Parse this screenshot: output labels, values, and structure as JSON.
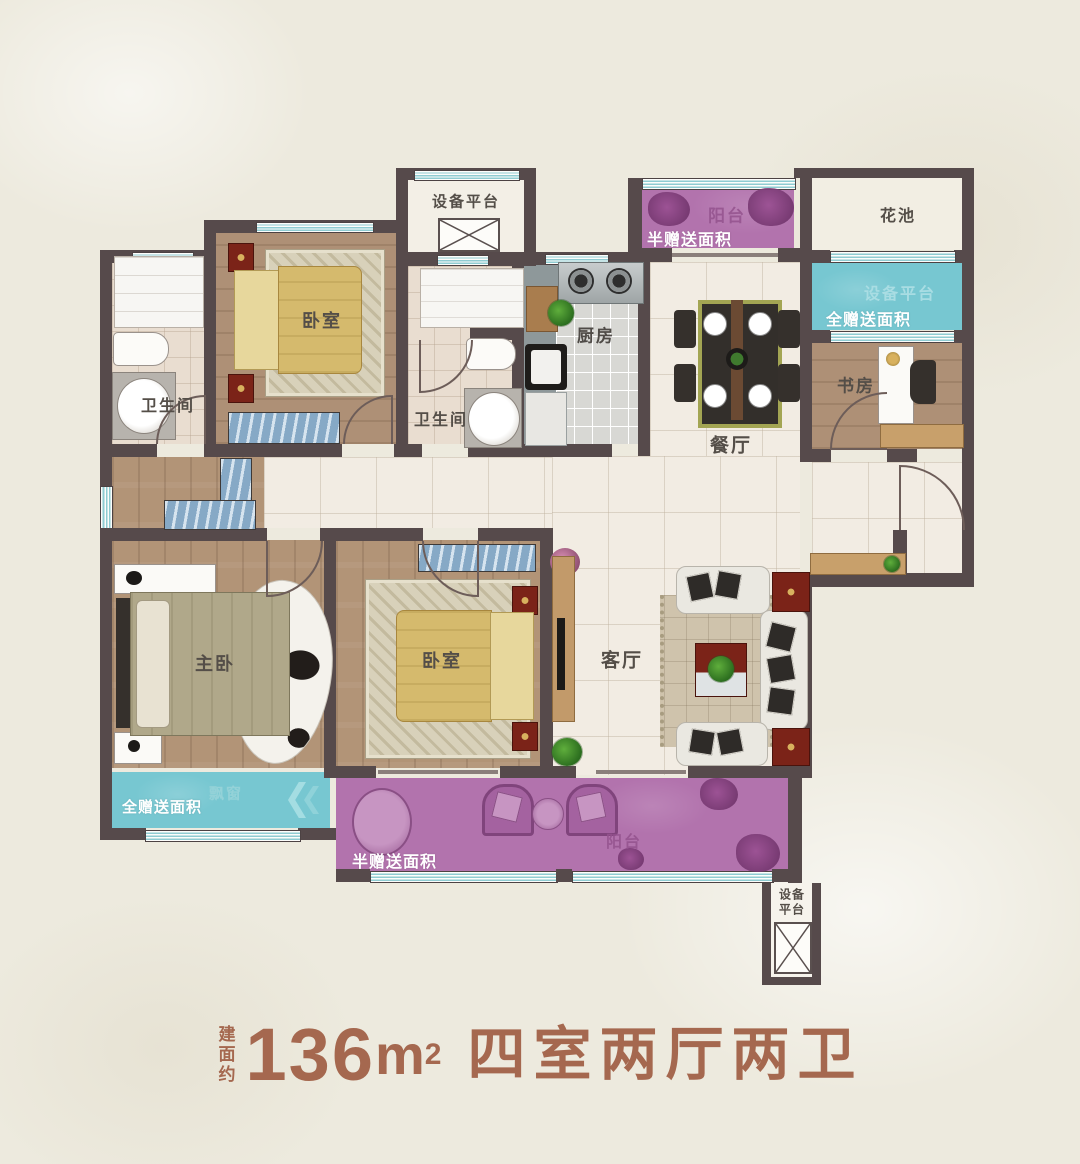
{
  "labels": {
    "equip_top": "设备平台",
    "balcony_top": "阳台",
    "flower_bed": "花池",
    "equip_right": "设备平台",
    "study": "书房",
    "kitchen": "厨房",
    "dining": "餐厅",
    "bath1": "卫生间",
    "bath2": "卫生间",
    "bedroom1": "卧室",
    "bedroom2": "卧室",
    "master": "主卧",
    "living": "客厅",
    "bay_window": "飘窗",
    "balcony_bottom": "阳台",
    "equip_bottom_line1": "设备",
    "equip_bottom_line2": "平台"
  },
  "annotations": {
    "half_gift_top": "半赠送面积",
    "full_gift_right": "全赠送面积",
    "full_gift_left": "全赠送面积",
    "half_gift_bottom": "半赠送面积"
  },
  "title": {
    "prefix": "建面约",
    "area": "136",
    "unit": "m",
    "sup": "2",
    "suffix": "四室两厅两卫"
  },
  "colors": {
    "wall": "#564a4b",
    "gift_full_teal": "#77c7d1",
    "gift_half_purple": "#b273ad",
    "title_accent": "#a5684f",
    "background": "#edeade"
  }
}
